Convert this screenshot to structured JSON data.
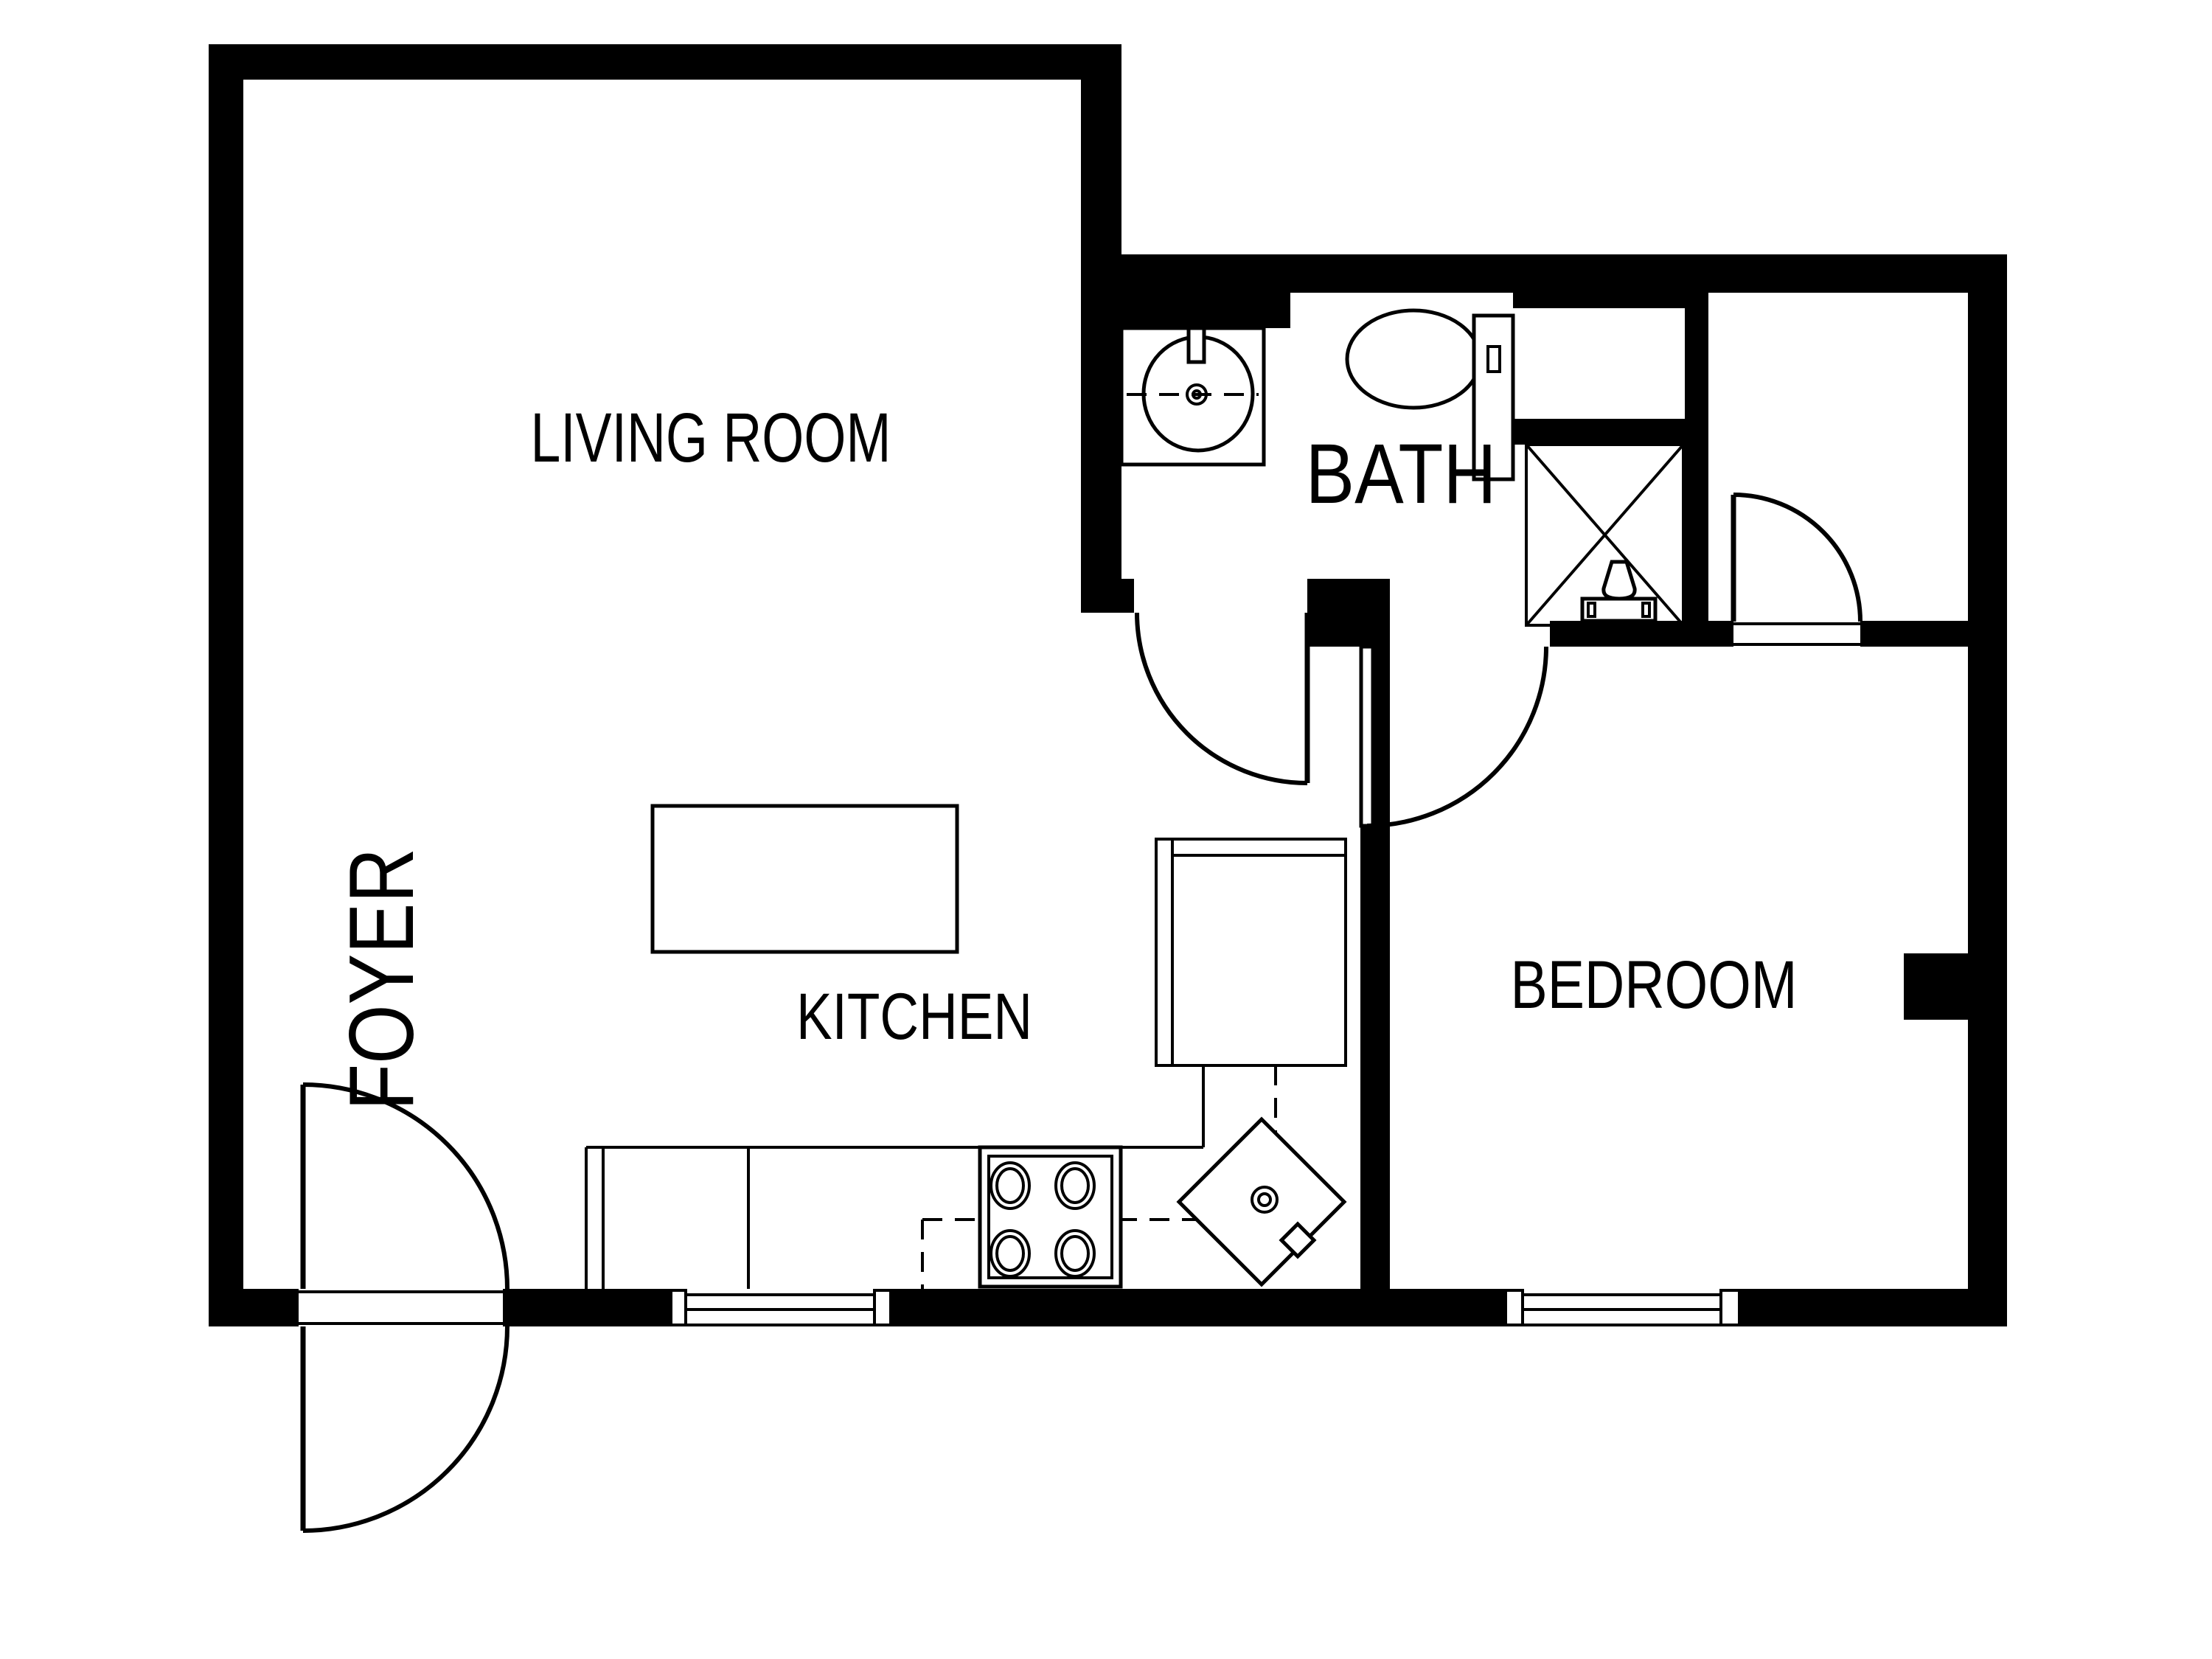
{
  "title": "Apartment floor plan",
  "colors": {
    "wall": "#000000",
    "background": "#ffffff",
    "line": "#000000"
  },
  "rooms": {
    "living_room": {
      "label": "LIVING ROOM"
    },
    "kitchen": {
      "label": "KITCHEN"
    },
    "bath": {
      "label": "BATH"
    },
    "bedroom": {
      "label": "BEDROOM"
    },
    "foyer": {
      "label": "FOYER"
    }
  },
  "fixtures": {
    "bath_sink": "bathroom-sink-icon",
    "toilet": "toilet-icon",
    "shower": "shower-stall-icon",
    "stove": "stove-burners-icon",
    "corner_sink": "kitchen-corner-sink-icon",
    "island": "kitchen-island",
    "counters": "kitchen-counter",
    "entry_door": "double-swing-door",
    "windows": "window-symbol"
  }
}
